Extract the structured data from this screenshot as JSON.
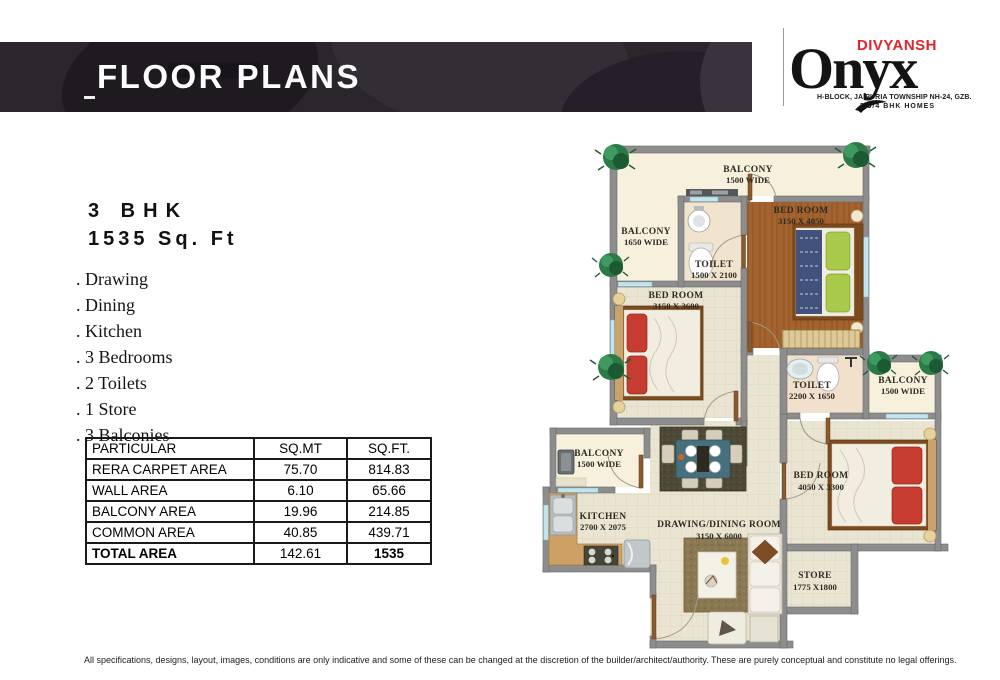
{
  "header": {
    "title": "FLOOR PLANS"
  },
  "logo": {
    "brand": "DIVYANSH",
    "name": "Onyx",
    "tagline1": "H-BLOCK, JAIPURIA TOWNSHIP NH-24, GZB.",
    "tagline2": "2/3/4 BHK HOMES",
    "brand_color": "#e3232b"
  },
  "unit": {
    "type": "3 BHK",
    "area": "1535 Sq. Ft",
    "features": [
      ". Drawing",
      ". Dining",
      ". Kitchen",
      ". 3 Bedrooms",
      ". 2 Toilets",
      ". 1 Store",
      ". 3 Balconies"
    ]
  },
  "area_table": {
    "headers": [
      "PARTICULAR",
      "SQ.MT",
      "SQ.FT."
    ],
    "rows": [
      [
        "RERA CARPET AREA",
        "75.70",
        "814.83"
      ],
      [
        "WALL AREA",
        "6.10",
        "65.66"
      ],
      [
        "BALCONY AREA",
        "19.96",
        "214.85"
      ],
      [
        "COMMON AREA",
        "40.85",
        "439.71"
      ],
      [
        "TOTAL AREA",
        "142.61",
        "1535"
      ]
    ]
  },
  "floor_plan": {
    "rooms": {
      "balcony_top": {
        "label": "BALCONY",
        "dims": "1500 WIDE"
      },
      "balcony_left": {
        "label": "BALCONY",
        "dims": "1650 WIDE"
      },
      "toilet_1": {
        "label": "TOILET",
        "dims": "1500 X 2100"
      },
      "bedroom_master": {
        "label": "BED ROOM",
        "dims": "3150 X 4050"
      },
      "bedroom_2": {
        "label": "BED ROOM",
        "dims": "3150 X 3600"
      },
      "toilet_2": {
        "label": "TOILET",
        "dims": "2200 X 1650"
      },
      "balcony_right": {
        "label": "BALCONY",
        "dims": "1500 WIDE"
      },
      "balcony_kitchen": {
        "label": "BALCONY",
        "dims": "1500 WIDE"
      },
      "kitchen": {
        "label": "KITCHEN",
        "dims": "2700 X 2075"
      },
      "drawing_dining": {
        "label": "DRAWING/DINING ROOM",
        "dims": "3150 X 6000"
      },
      "bedroom_3": {
        "label": "BED ROOM",
        "dims": "4050 X 3300"
      },
      "store": {
        "label": "STORE",
        "dims": "1775 X1800"
      }
    },
    "colors": {
      "wall_gray": "#8d8d8d",
      "floor_tile": "#eae5d2",
      "wood_floor": "#a4632e",
      "balcony_floor": "#f7f0dd",
      "header_bar": "#2b262c"
    }
  },
  "disclaimer": "All specifications, designs, layout, images, conditions are only indicative and some of these can be changed at the discretion of the builder/architect/authority. These are purely conceptual and constitute no legal offerings."
}
